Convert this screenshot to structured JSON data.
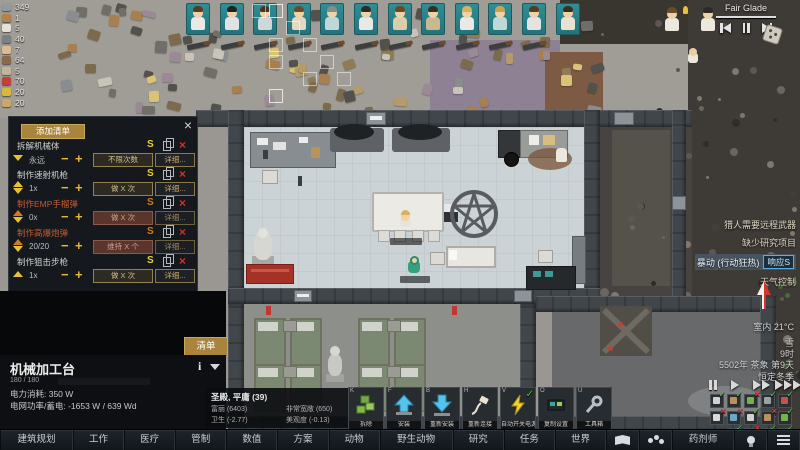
{
  "resources": [
    {
      "name": "steel",
      "value": "349",
      "color": "#93999d"
    },
    {
      "name": "wood",
      "value": "1",
      "color": "#b08449"
    },
    {
      "name": "cloth",
      "value": "5",
      "color": "#e6e2d8"
    },
    {
      "name": "stone-blocks",
      "value": "40",
      "color": "#7d8082"
    },
    {
      "name": "meals",
      "value": "7",
      "color": "#d9ba91"
    },
    {
      "name": "leather",
      "value": "64",
      "color": "#8a6a48"
    },
    {
      "name": "textiles",
      "value": "5",
      "color": "#c2b49a"
    },
    {
      "name": "berries",
      "value": "70",
      "color": "#c24138"
    },
    {
      "name": "gold",
      "value": "20",
      "color": "#d9b93c"
    },
    {
      "name": "fabric",
      "value": "20",
      "color": "#c9a869"
    }
  ],
  "music": {
    "title": "Fair Glade"
  },
  "bills_window": {
    "add_button": "添加清单",
    "close_label": "×",
    "suspend_glyph": "S",
    "delete_glyph": "×",
    "minus_glyph": "−",
    "plus_glyph": "+",
    "bills": [
      {
        "name": "拆解机械体",
        "repeat": "永远",
        "mode": "不限次数",
        "details": "详细...",
        "suspended": false,
        "chevrons": [
          [
            "down",
            "#e8c232"
          ]
        ]
      },
      {
        "name": "制作速射机枪",
        "repeat": "1x",
        "mode": "做 X 次",
        "details": "详细...",
        "suspended": false,
        "chevrons": [
          [
            "up",
            "#e8c232"
          ],
          [
            "down",
            "#e8c232"
          ]
        ]
      },
      {
        "name": "制作EMP手榴弹",
        "repeat": "0x",
        "mode": "做 X 次",
        "details": "详细...",
        "suspended": true,
        "chevrons": [
          [
            "up",
            "#d07a28"
          ],
          [
            "down",
            "#e8c232"
          ]
        ]
      },
      {
        "name": "制作高爆炮弹",
        "repeat": "20/20",
        "mode": "维持 X 个",
        "details": "详细...",
        "suspended": true,
        "chevrons": [
          [
            "up",
            "#d07a28"
          ],
          [
            "down",
            "#e8c232"
          ]
        ]
      },
      {
        "name": "制作狙击步枪",
        "repeat": "1x",
        "mode": "做 X 次",
        "details": "详细...",
        "suspended": false,
        "chevrons": [
          [
            "up",
            "#e8c232"
          ]
        ]
      }
    ]
  },
  "inspect": {
    "tab": "清单",
    "title": "机械加工台",
    "info_icon": "i",
    "hp": "180 / 180",
    "power": "电力消耗: 350 W",
    "grid": "电网功率/蓄电: -1653 W / 639 Wd"
  },
  "room_tooltip": {
    "title": "圣殿, 平庸 (39)",
    "stats": [
      "富丽 (6403)",
      "非常宽敞 (650)",
      "卫生 (-2.77)",
      "美观度 (-0.13)"
    ]
  },
  "gizmos": [
    {
      "hotkey": "K",
      "label": "拆除"
    },
    {
      "hotkey": "F",
      "label": "安装"
    },
    {
      "hotkey": "B",
      "label": "重新安装"
    },
    {
      "hotkey": "H",
      "label": "重新连接"
    },
    {
      "hotkey": "V",
      "label": "自动开关电源",
      "checked": "✓"
    },
    {
      "hotkey": "O",
      "label": "复制设置"
    },
    {
      "hotkey": "U",
      "label": "工具箱"
    }
  ],
  "alerts": [
    {
      "label": "猎人需要远程武器"
    },
    {
      "label": "缺少研究项目"
    },
    {
      "label": "暴动 (行动狂热)",
      "button": "响应S",
      "highlight": true
    },
    {
      "label": "天气控制"
    }
  ],
  "clock": {
    "temperature": "室内 21°C",
    "weather": "雪",
    "time": "9时",
    "date": "5502年 茶象 第9天",
    "season": "恒定冬季"
  },
  "bottom_bar": {
    "tabs": [
      {
        "label": "建筑规划"
      },
      {
        "label": "工作"
      },
      {
        "label": "医疗"
      },
      {
        "label": "管制"
      },
      {
        "label": "数值"
      },
      {
        "label": "方案"
      },
      {
        "label": "动物"
      },
      {
        "label": "野生动物"
      },
      {
        "label": "研究"
      },
      {
        "label": "任务"
      },
      {
        "label": "世界"
      },
      {
        "icon": "book"
      },
      {
        "icon": "people"
      },
      {
        "label": "药剂师"
      },
      {
        "icon": "bulb"
      },
      {
        "icon": "menu"
      }
    ]
  },
  "toggles": [
    "on",
    "on",
    "off",
    "on",
    "on",
    "off",
    "off",
    "on",
    "off",
    "on",
    "on",
    "off",
    "on",
    "on"
  ],
  "pawn_bar": {
    "count": 12
  }
}
